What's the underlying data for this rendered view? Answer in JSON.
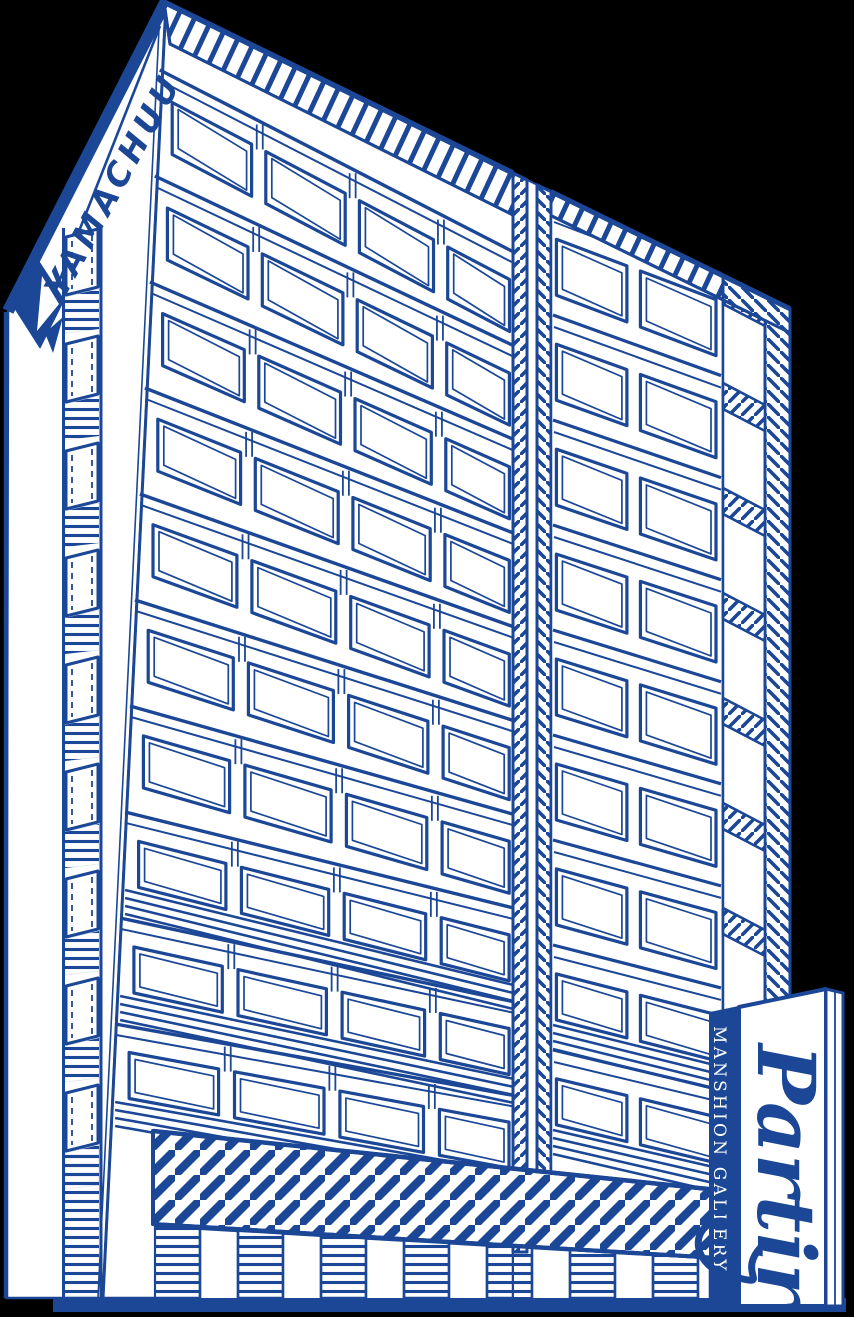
{
  "scene": {
    "background_color": "#000000",
    "ink_color": "#1B4796",
    "paper_color": "#FFFFFF",
    "description": "Blue line-art illustration of a high-rise mansion building"
  },
  "texts": {
    "company_name": "YAMACHUU",
    "sign_script": "Partir",
    "sign_strip": "MANSHION GALLERY"
  }
}
